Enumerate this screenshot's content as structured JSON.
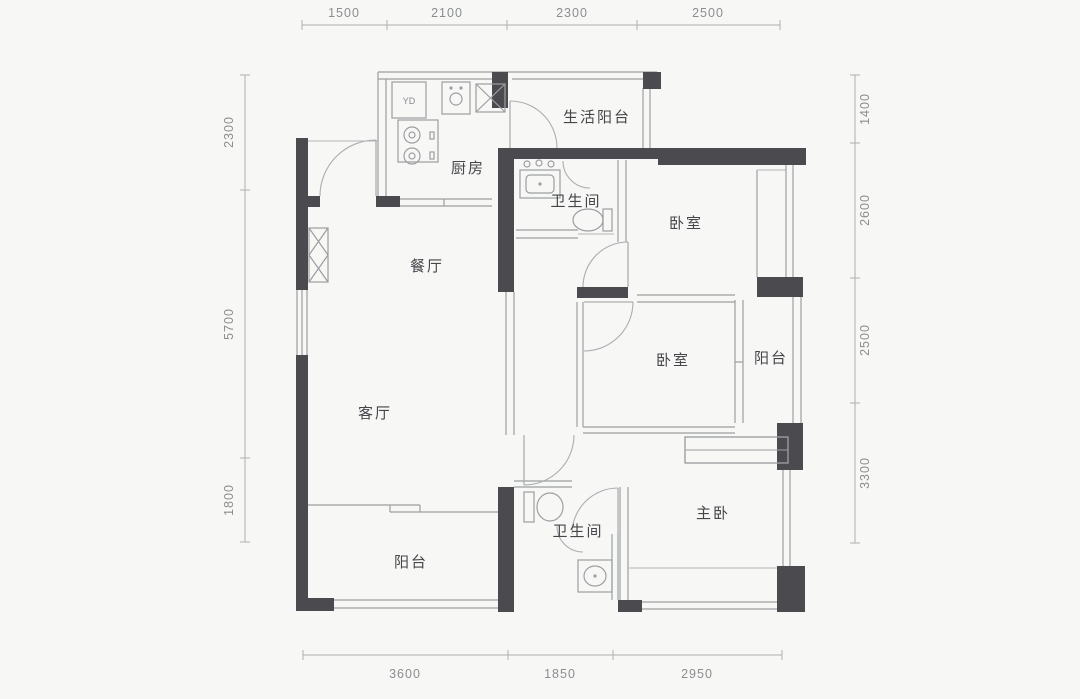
{
  "plan": {
    "type": "apartment-floor-plan",
    "rooms": {
      "living_balcony": "生活阳台",
      "kitchen": "厨房",
      "bathroom_1": "卫生间",
      "bedroom_1": "卧室",
      "dining": "餐厅",
      "bedroom_2": "卧室",
      "balcony_mid": "阳台",
      "living": "客厅",
      "master_bedroom": "主卧",
      "bathroom_2": "卫生间",
      "balcony_bottom": "阳台"
    },
    "appliances": {
      "washer_box": "YD"
    },
    "dimensions": {
      "top": [
        "1500",
        "2100",
        "2300",
        "2500"
      ],
      "bottom": [
        "3600",
        "1850",
        "2950"
      ],
      "left": [
        "2300",
        "5700",
        "1800"
      ],
      "right": [
        "1400",
        "2600",
        "2500",
        "3300"
      ]
    },
    "colors": {
      "wall": "#4b4b4f",
      "thin_line": "#9b9ea1",
      "door_arc": "#abaeb1",
      "room_text": "#45464a",
      "dimension_text": "#8b8d90",
      "background": "#f7f7f6"
    }
  }
}
